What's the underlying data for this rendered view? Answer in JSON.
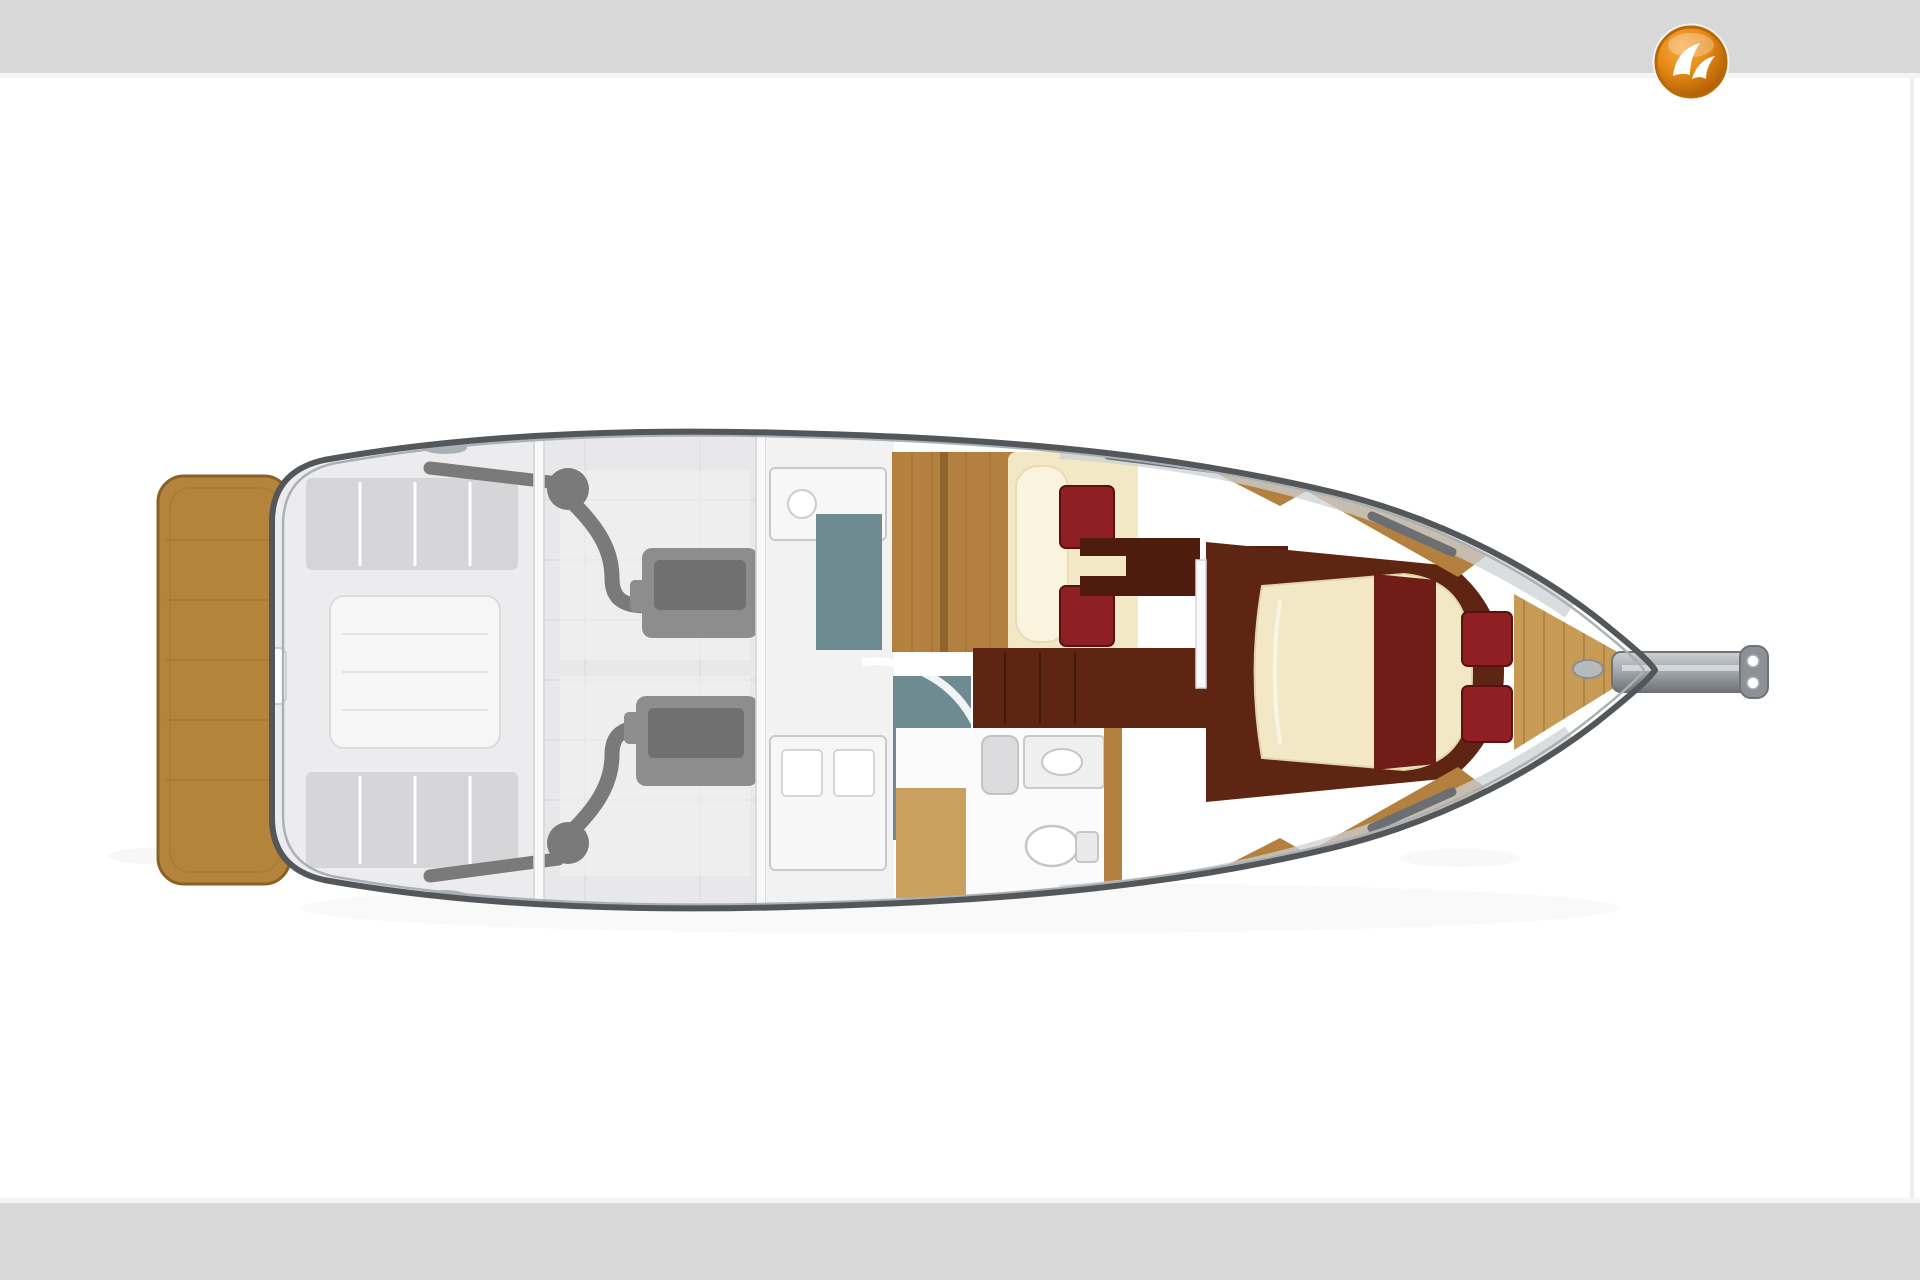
{
  "page": {
    "kind": "yacht-brokerage-image-page",
    "header_band": {
      "x": 0,
      "y": 0,
      "w": 1920,
      "h": 73
    },
    "footer_band": {
      "x": 0,
      "y": 1203,
      "w": 1920,
      "h": 77
    }
  },
  "logo": {
    "name": "orange-bird-logo",
    "shape": "glossy-orange-circle-with-white-bird",
    "cx": 1691,
    "cy": 62,
    "r": 35
  },
  "floor_plan": {
    "type": "yacht-deck-accommodation-plan",
    "orientation": "bow-right",
    "areas": [
      "swim-platform",
      "cockpit",
      "engine-room-twin-engines",
      "galley",
      "shower",
      "head-bathroom",
      "guest-cabin-twin-berths",
      "owner-cabin-island-berth",
      "foredeck",
      "bowsprit-anchor-roller"
    ]
  },
  "colors": {
    "page": "#ffffff",
    "band": "#d8d8d8",
    "band_edge": "#f5f5f5",
    "right_line": "#ececec",
    "hull_outline": "#54575a",
    "hull_inner": "#aab0b4",
    "hull_fill": "#ffffff",
    "platform": "#b5843c",
    "platform_dark": "#8a6125",
    "platform_seam": "#a3752f",
    "cockpit": "#ececee",
    "bench": "#d6d6d8",
    "table": "#f6f6f7",
    "engine_room": "#e8e8ea",
    "engine": "#8d8d8d",
    "engine_dark": "#6d6d6d",
    "hose": "#7a7a7a",
    "bulkhead": "#f8f8f8",
    "bulkhead_line": "#d2d2d2",
    "galley": "#f2f2f3",
    "fixture": "#f7f7f8",
    "fixture_line": "#c9c9cb",
    "teal": "#6f8b92",
    "wood": "#b3803f",
    "wood_light": "#c79b55",
    "wood_dark": "#8a5f2a",
    "maroon": "#5e2512",
    "maroon_deep": "#4d1c0d",
    "runner": "#701d18",
    "red_cushion": "#8e1f22",
    "red_cushion_edge": "#5d1012",
    "cream": "#f3e8c6",
    "cream_light": "#faf3dd",
    "deck_strip": "#ced2d4",
    "rail": "#6b6f73",
    "cleat": "#9aa0a4",
    "metal": "#9aa0a5",
    "metal_dark": "#6f7377",
    "logo_orange": "#e78a15",
    "logo_orange_hi": "#f5ab4a",
    "logo_orange_deep": "#a35501",
    "logo_ring": "#b96a06",
    "logo_glyph": "#ffffff",
    "shadow": "#8a8a8a"
  }
}
